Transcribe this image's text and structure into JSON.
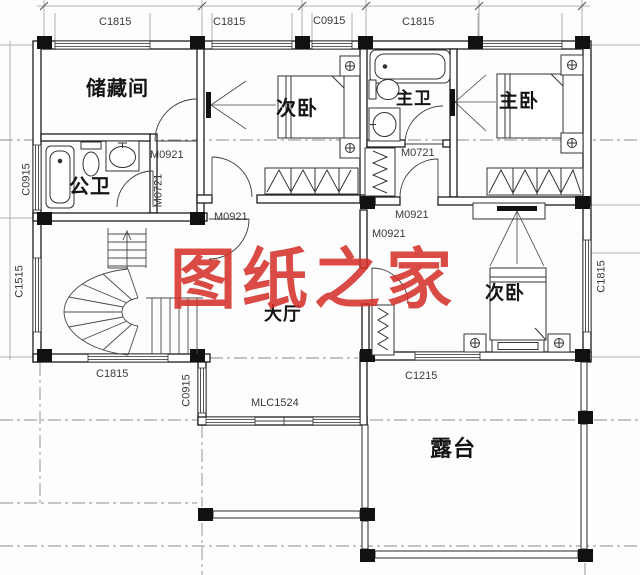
{
  "meta": {
    "drawing_type": "residential floor plan",
    "line_color": "#1c1c1c",
    "watermark_color": "#d53028"
  },
  "watermark": {
    "text": "图纸之家"
  },
  "rooms": {
    "storage": "储藏间",
    "bedroom_top": "次卧",
    "master_bath": "主卫",
    "master_bedroom": "主卧",
    "public_bath": "公卫",
    "hall": "大厅",
    "bedroom_bottom": "次卧",
    "terrace": "露台"
  },
  "windows": {
    "top1": "C1815",
    "top2": "C1815",
    "top3": "C0915",
    "top4": "C1815",
    "left1": "C0915",
    "left2": "C1515",
    "right1": "C1815",
    "bottom_stair": "C1815",
    "entry_side": "C0915",
    "entry_doorwindow": "MLC1524",
    "bottom_bedroom": "C1215"
  },
  "doors": {
    "storage": "M0921",
    "public_bath": "M0721",
    "bedroom_top": "M0921",
    "master_bath": "M0721",
    "vestibule": "M0921",
    "bedroom_bottom": "M0921"
  }
}
